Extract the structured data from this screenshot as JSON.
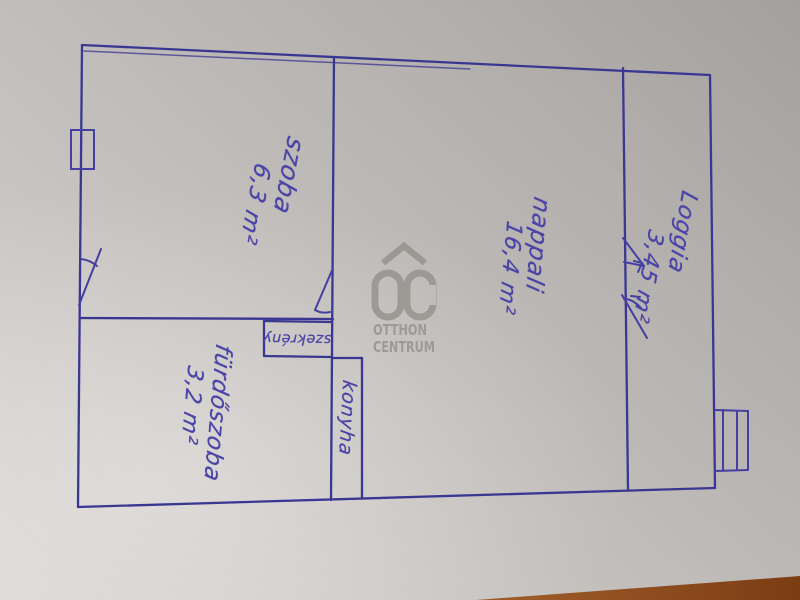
{
  "rooms": [
    {
      "name": "szoba",
      "area": "6,3 m²"
    },
    {
      "name": "nappali",
      "area": "16,4 m²"
    },
    {
      "name": "Loggia",
      "area": "3,45 m²"
    },
    {
      "name": "fürdőszoba",
      "area": "3,2 m²"
    },
    {
      "name": "konyha",
      "area": ""
    },
    {
      "name": "szekrény",
      "area": ""
    }
  ],
  "logo": {
    "monogram": "OC",
    "line1": "OTTHON",
    "line2": "CENTRUM"
  },
  "colors": {
    "pen_ink": "#413e9c",
    "paper": "#c2beba",
    "table_wood": "#8e4c1e",
    "logo_gray": "#9a9793"
  }
}
